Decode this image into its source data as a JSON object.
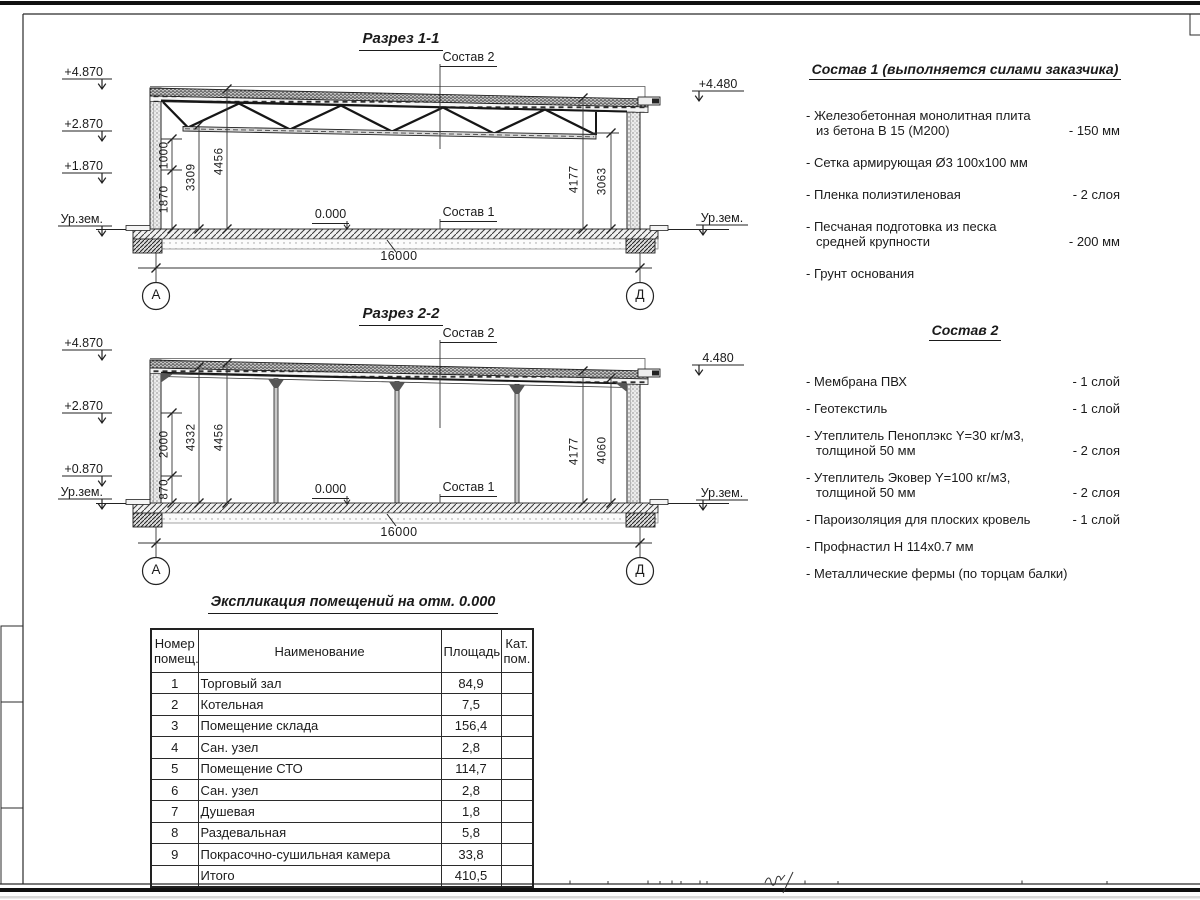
{
  "s1": {
    "title": "Разрез 1-1",
    "elev_left": [
      "+4.870",
      "+2.870",
      "+1.870",
      "Ур.зем."
    ],
    "elev_right_top": "+4.480",
    "elev_right_ground": "Ур.зем.",
    "label_comp2": "Состав 2",
    "label_comp1": "Состав 1",
    "zero": "0.000",
    "dim_1000": "1000",
    "dim_1870": "1870",
    "dim_3309": "3309",
    "dim_4456": "4456",
    "dim_4177": "4177",
    "dim_3063": "3063",
    "span": "16000",
    "axis_left": "А",
    "axis_right": "Д"
  },
  "s2": {
    "title": "Разрез 2-2",
    "elev_left": [
      "+4.870",
      "+2.870",
      "+0.870",
      "Ур.зем."
    ],
    "elev_right_top": "4.480",
    "elev_right_ground": "Ур.зем.",
    "label_comp2": "Состав 2",
    "label_comp1": "Состав 1",
    "zero": "0.000",
    "dim_2000": "2000",
    "dim_870": "870",
    "dim_4332": "4332",
    "dim_4456": "4456",
    "dim_4177": "4177",
    "dim_4060": "4060",
    "span": "16000",
    "axis_left": "А",
    "axis_right": "Д"
  },
  "comp1": {
    "title": "Состав 1 (выполняется силами заказчика)",
    "items": [
      {
        "text": "- Железобетонная монолитная плита\nиз бетона В 15 (М200)",
        "value": "- 150 мм"
      },
      {
        "text": "- Сетка армирующая Ø3 100х100 мм",
        "value": ""
      },
      {
        "text": "- Пленка полиэтиленовая",
        "value": "-  2 слоя"
      },
      {
        "text": "- Песчаная подготовка из песка\nсредней крупности",
        "value": "- 200 мм"
      },
      {
        "text": "- Грунт основания",
        "value": ""
      }
    ]
  },
  "comp2": {
    "title": "Состав 2",
    "items": [
      {
        "text": "- Мембрана ПВХ",
        "value": "- 1 слой"
      },
      {
        "text": "- Геотекстиль",
        "value": "- 1 слой"
      },
      {
        "text": "- Утеплитель Пеноплэкс Y=30 кг/м3,\nтолщиной 50 мм",
        "value": "- 2 слоя"
      },
      {
        "text": "- Утеплитель Эковер Y=100 кг/м3,\nтолщиной 50 мм",
        "value": "- 2 слоя"
      },
      {
        "text": "- Пароизоляция для плоских кровель",
        "value": "- 1 слой"
      },
      {
        "text": "- Профнастил Н 114х0.7 мм",
        "value": ""
      },
      {
        "text": "- Металлические фермы (по торцам балки)",
        "value": ""
      }
    ]
  },
  "schedule": {
    "title": "Экспликация помещений на отм. 0.000",
    "headers": [
      "Номер\nпомещ.",
      "Наименование",
      "Площадь",
      "Кат.\nпом."
    ],
    "rows": [
      [
        "1",
        "Торговый зал",
        "84,9",
        ""
      ],
      [
        "2",
        "Котельная",
        "7,5",
        ""
      ],
      [
        "3",
        "Помещение склада",
        "156,4",
        ""
      ],
      [
        "4",
        "Сан. узел",
        "2,8",
        ""
      ],
      [
        "5",
        "Помещение СТО",
        "114,7",
        ""
      ],
      [
        "6",
        "Сан. узел",
        "2,8",
        ""
      ],
      [
        "7",
        "Душевая",
        "1,8",
        ""
      ],
      [
        "8",
        "Раздевальная",
        "5,8",
        ""
      ],
      [
        "9",
        "Покрасочно-сушильная камера",
        "33,8",
        ""
      ],
      [
        "",
        "Итого",
        "410,5",
        ""
      ]
    ]
  }
}
